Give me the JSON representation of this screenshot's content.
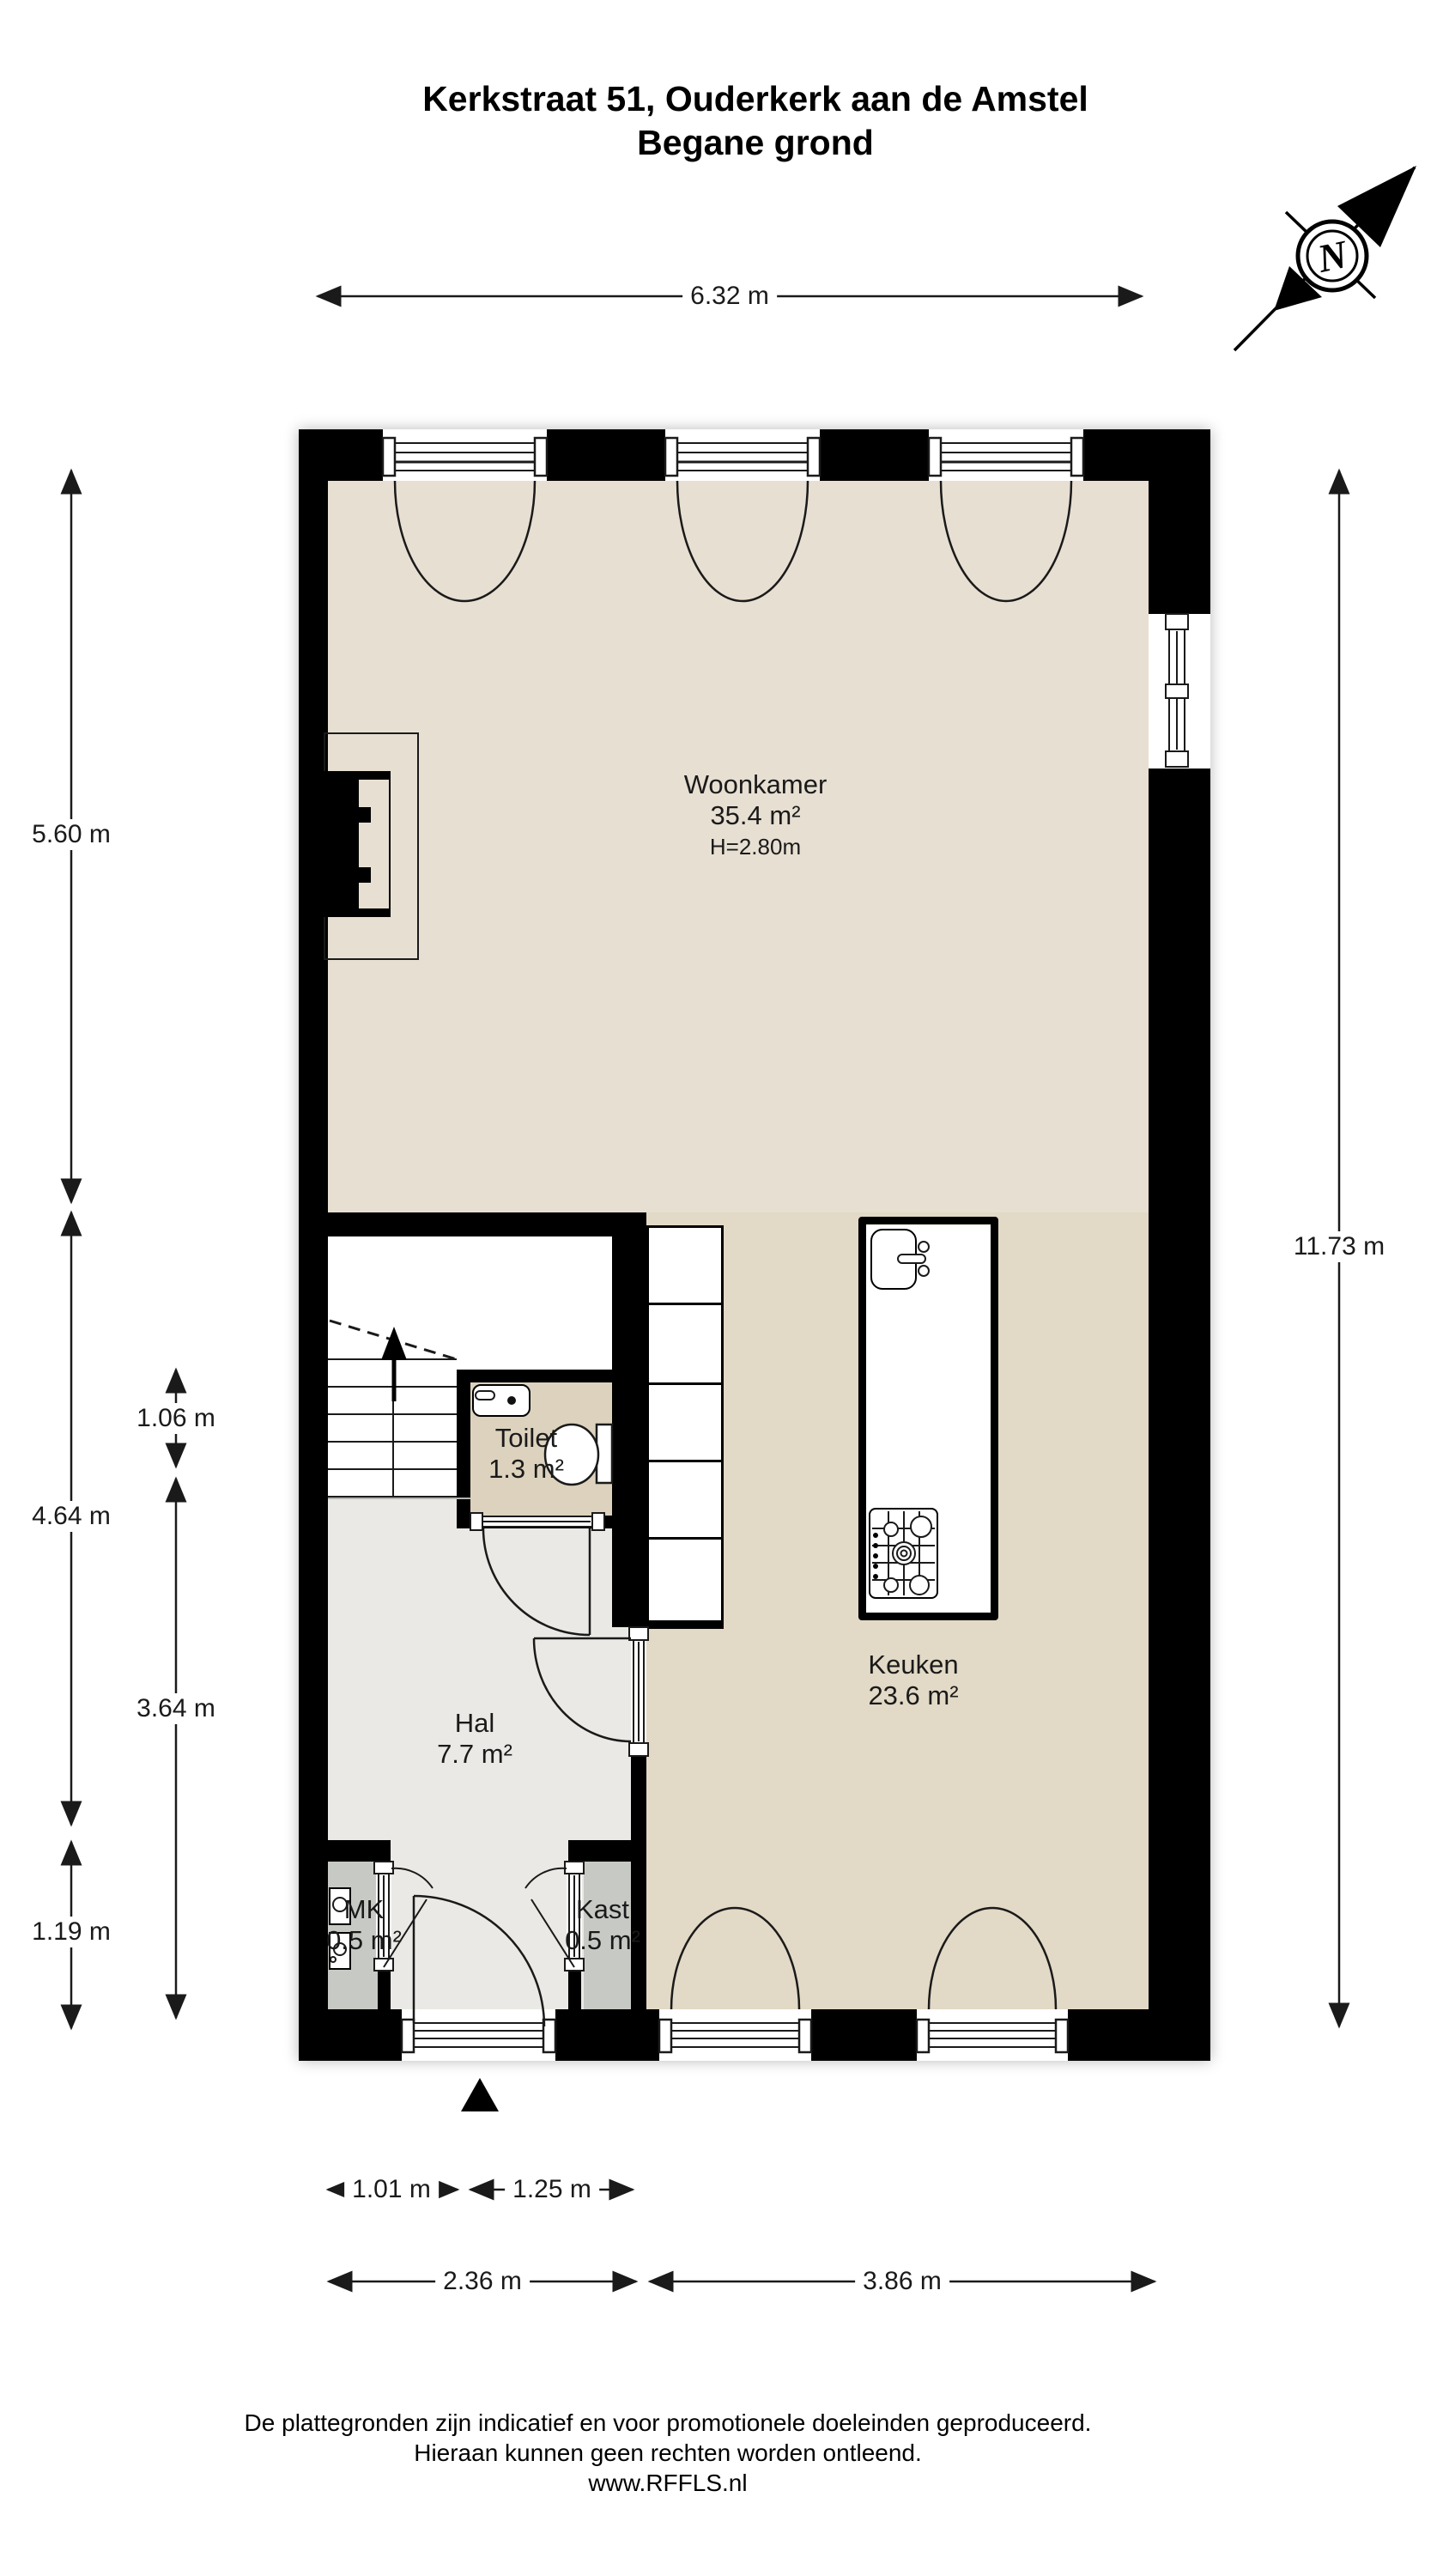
{
  "title": {
    "line1": "Kerkstraat 51, Ouderkerk aan de Amstel",
    "line2": "Begane grond"
  },
  "compass": {
    "label": "N"
  },
  "rooms": {
    "woonkamer": {
      "name": "Woonkamer",
      "area": "35.4 m²",
      "ceiling_height": "H=2.80m"
    },
    "keuken": {
      "name": "Keuken",
      "area": "23.6 m²"
    },
    "hal": {
      "name": "Hal",
      "area": "7.7 m²"
    },
    "toilet": {
      "name": "Toilet",
      "area": "1.3 m²"
    },
    "mk": {
      "name": "MK",
      "area": "0.5 m²"
    },
    "kast": {
      "name": "Kast",
      "area": "0.5 m²"
    }
  },
  "dimensions": {
    "top": "6.32 m",
    "left_upper": "5.60 m",
    "left_middle": "4.64 m",
    "left_lower": "1.19 m",
    "inner_upper": "1.06 m",
    "inner_lower": "3.64 m",
    "right": "11.73 m",
    "bottom_stair": "1.01 m",
    "bottom_door": "1.25 m",
    "bottom_hal": "2.36 m",
    "bottom_keuken": "3.86 m"
  },
  "footer": {
    "line1": "De plattegronden zijn indicatief en voor promotionele doeleinden geproduceerd.",
    "line2": "Hieraan kunnen geen rechten worden ontleend.",
    "line3": "www.RFFLS.nl"
  },
  "colors": {
    "wall": "#000000",
    "floor_living": "#e7dfd2",
    "floor_kitchen": "#e2d9c6",
    "floor_toilet": "#dcd2bd",
    "floor_hall": "#eae9e5",
    "floor_closet": "#c7c9c4"
  }
}
